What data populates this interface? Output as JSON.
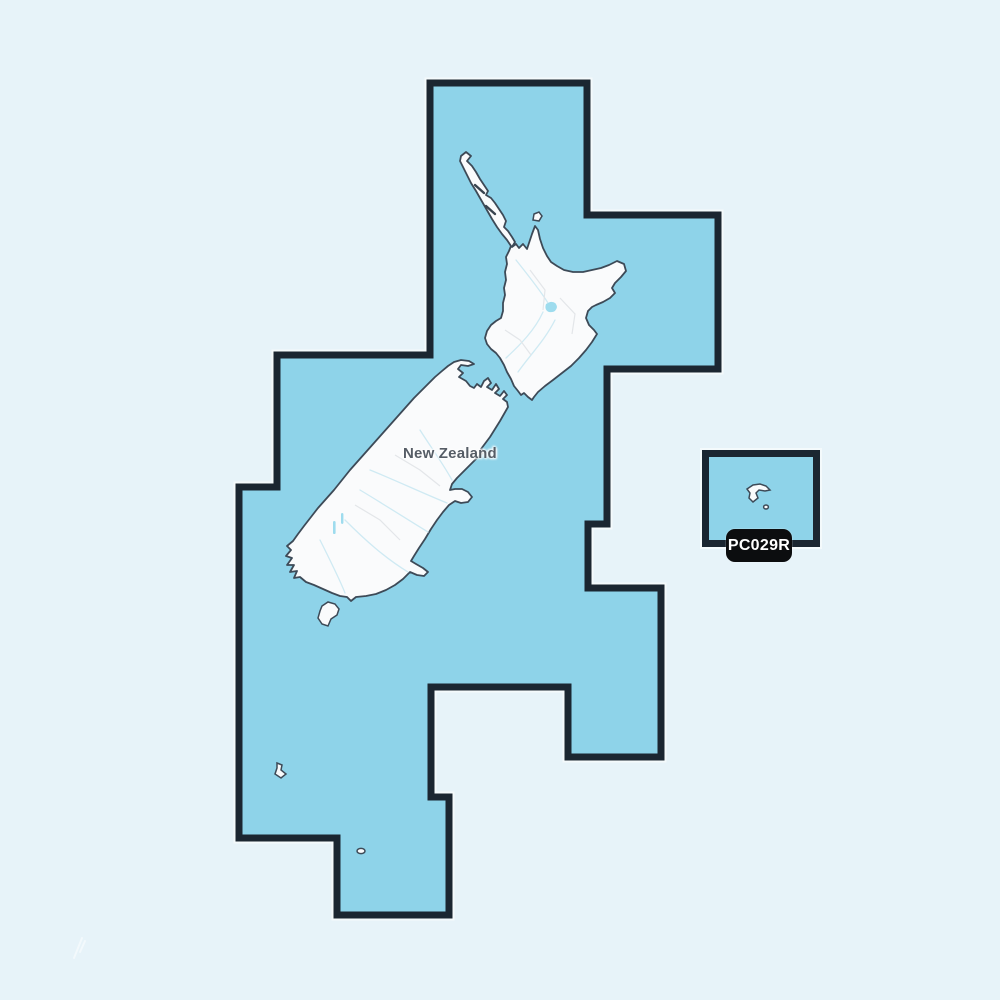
{
  "map": {
    "country_label": "New Zealand",
    "region_badge": "PC029R",
    "colors": {
      "outside_sea": "#e7f3f9",
      "coverage_sea": "#8ed3e9",
      "coverage_border": "#1b2631",
      "land": "#fafbfc",
      "coastline": "#3d4a57",
      "lake": "#9edcee",
      "river": "#cfeaf3",
      "badge_background": "#0c0d0f",
      "badge_text": "#ffffff",
      "label_text": "#565d66"
    }
  }
}
